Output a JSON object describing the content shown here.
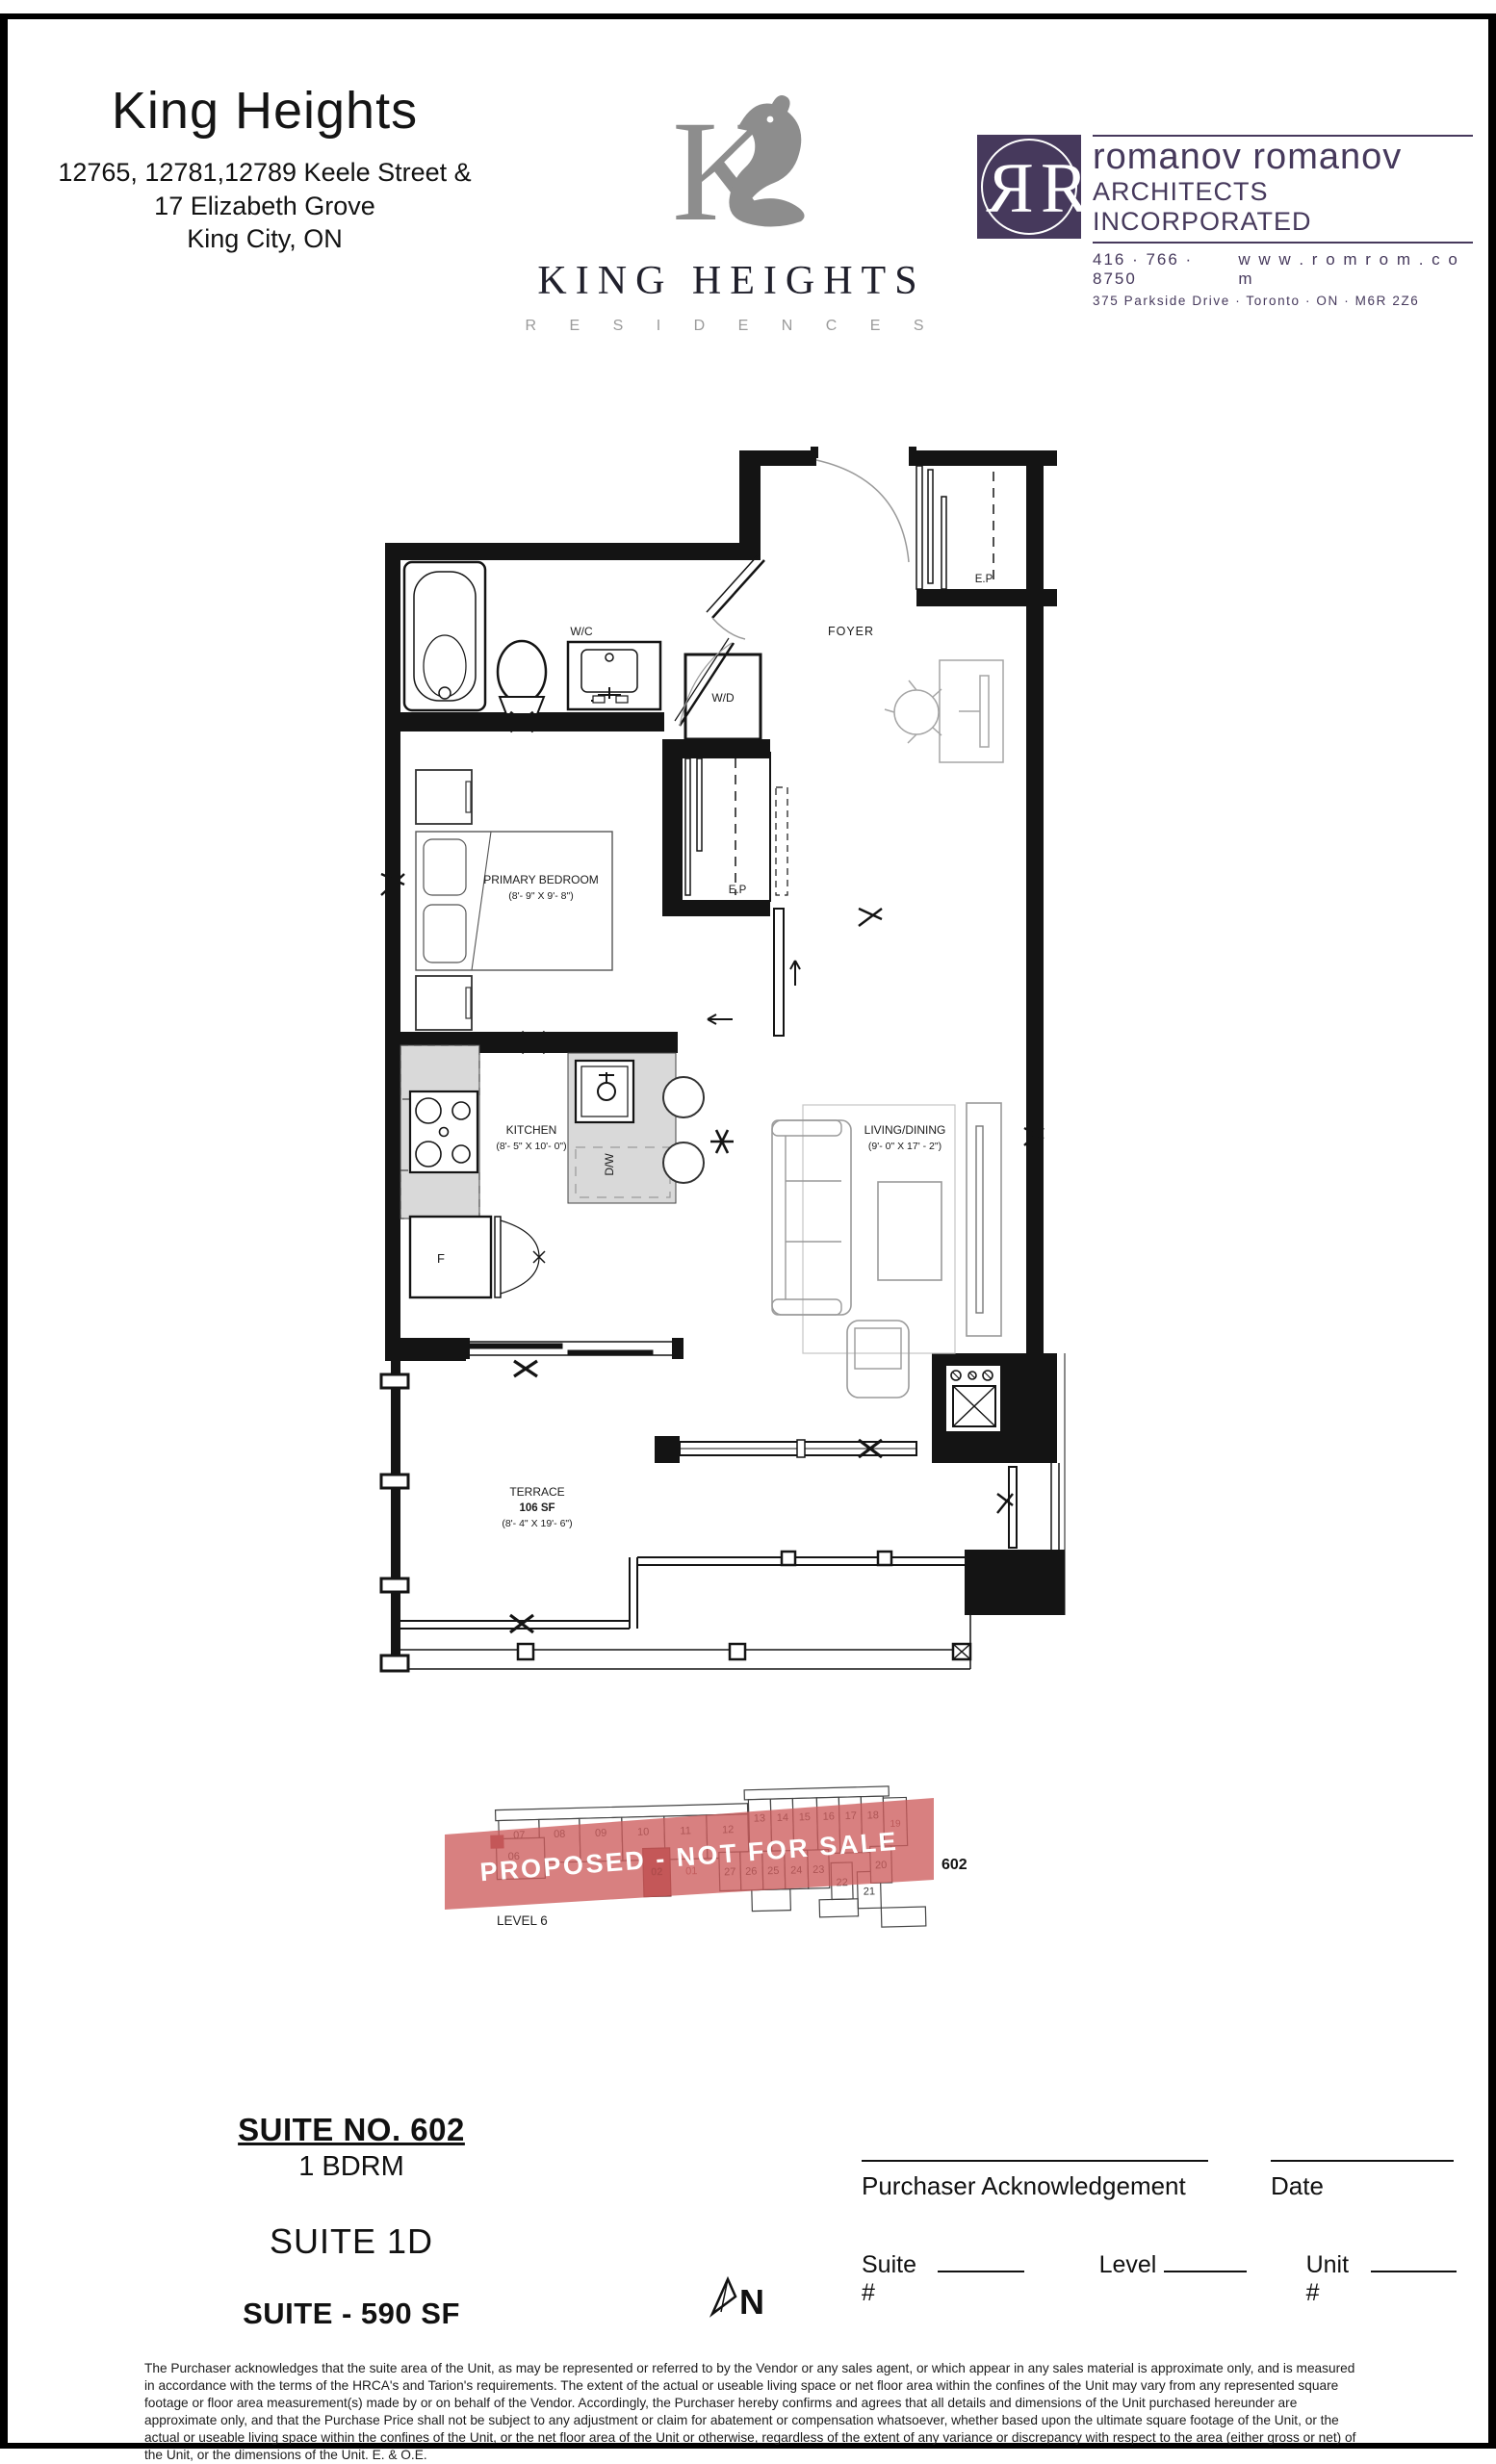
{
  "header": {
    "project": {
      "title": "King Heights",
      "address_line1": "12765, 12781,12789 Keele Street &",
      "address_line2": "17 Elizabeth Grove",
      "address_line3": "King City, ON"
    },
    "brand": {
      "wordmark": "KING HEIGHTS",
      "subword": "R E S I D E N C E S",
      "monogram_letter": "K"
    },
    "architect": {
      "monogram": "R",
      "name": "romanov romanov",
      "tagline": "ARCHITECTS INCORPORATED",
      "phone": "416 · 766 · 8750",
      "website": "w w w . r o m r o m . c o m",
      "address": "375 Parkside Drive  ·  Toronto  ·  ON  ·  M6R 2Z6",
      "brand_color": "#46395c"
    }
  },
  "floorplan": {
    "labels": {
      "wc": "W/C",
      "wd": "W/D",
      "foyer": "FOYER",
      "ep": "E.P",
      "closet_ep": "E.P",
      "bedroom_name": "PRIMARY BEDROOM",
      "bedroom_dims": "(8'- 9\" X 9'- 8\")",
      "kitchen_name": "KITCHEN",
      "kitchen_dims": "(8'- 5\" X 10'- 0\")",
      "dw": "D/W",
      "fridge": "F",
      "living_name": "LIVING/DINING",
      "living_dims": "(9'- 0\" X 17' - 2\")",
      "terrace_name": "TERRACE",
      "terrace_area": "106 SF",
      "terrace_dims": "(8'- 4\" X 19'- 6\")"
    }
  },
  "keyplan": {
    "watermark": "PROPOSED - NOT FOR SALE",
    "level": "LEVEL 6",
    "suite": "602",
    "top_units": [
      "07",
      "08",
      "09",
      "10",
      "11",
      "12"
    ],
    "right_units": [
      "13",
      "14",
      "15",
      "16",
      "17",
      "18"
    ],
    "hidden_unit": "19",
    "lower_left_unit": "06",
    "mid_units": [
      "02",
      "01"
    ],
    "lower_right_units": [
      "27",
      "26",
      "25",
      "24",
      "23",
      "22",
      "21",
      "20"
    ],
    "banner_color": "#cd5c5c",
    "highlight_color": "#a34648"
  },
  "suite_info": {
    "suite_no": "SUITE NO. 602",
    "type": "1 BDRM",
    "model": "SUITE 1D",
    "area": "SUITE - 590 SF"
  },
  "acknowledgement": {
    "purchaser_label": "Purchaser Acknowledgement",
    "date_label": "Date",
    "suite_label": "Suite #",
    "level_label": "Level",
    "unit_label": "Unit #"
  },
  "compass": {
    "label": "N"
  },
  "disclaimer": "The Purchaser acknowledges that the suite area of the Unit, as may be represented or referred to by the Vendor or any sales agent, or which appear in any sales material is approximate only, and is measured in accordance with the terms of the HRCA's and Tarion's requirements.  The extent of the actual or useable living space or net floor area within the confines of the Unit may vary from any represented square footage or floor area measurement(s) made by or on behalf of the Vendor. Accordingly, the Purchaser hereby confirms and agrees that all details and dimensions of the Unit purchased hereunder are approximate only, and that the Purchase Price shall not be subject to any adjustment or claim for abatement or compensation whatsoever, whether based upon the ultimate square footage of the Unit, or the actual or useable living space within the confines of the Unit, or the net floor area of the Unit or otherwise, regardless of the extent of any variance or discrepancy with respect to the area (either gross or net) of the Unit, or the dimensions of the Unit. E. & O.E."
}
